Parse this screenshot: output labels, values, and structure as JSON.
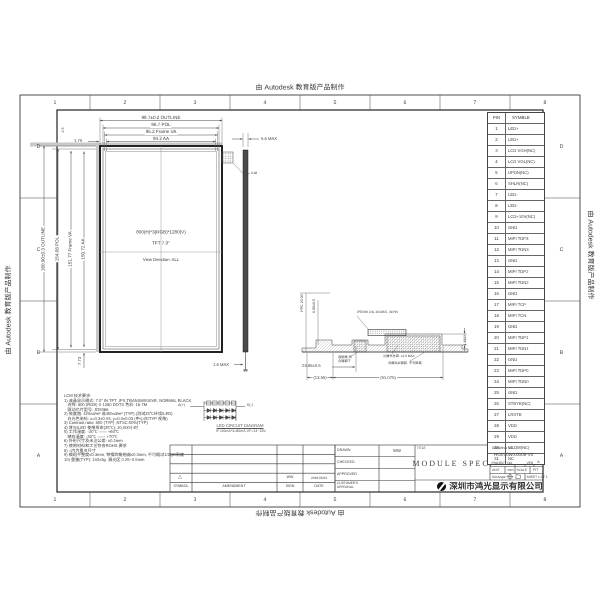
{
  "colors": {
    "line": "#3a3a3a",
    "panel_border": "#222222",
    "gray_strip": "#c8c8c8",
    "side_fill": "#4a4a4a"
  },
  "frame": {
    "autodesk_text": "由 Autodesk 教育版产品制作",
    "zone_columns": [
      "1",
      "2",
      "3",
      "4",
      "5",
      "6",
      "7",
      "8"
    ],
    "zone_rows": [
      "D",
      "C",
      "B",
      "A"
    ]
  },
  "pin_table": {
    "headers": [
      "PIN",
      "SYMBLE"
    ],
    "rows": [
      [
        "1",
        "LED+"
      ],
      [
        "2",
        "LED+"
      ],
      [
        "3",
        "LCD VGH(NC)"
      ],
      [
        "4",
        "LCD VGL(NC)"
      ],
      [
        "5",
        "UPDN(NC)"
      ],
      [
        "6",
        "SHLR(NC)"
      ],
      [
        "7",
        "LED-"
      ],
      [
        "8",
        "LED-"
      ],
      [
        "9",
        "LCD+10V(NC)"
      ],
      [
        "10",
        "GND"
      ],
      [
        "11",
        "MIPI TDP3"
      ],
      [
        "12",
        "MIPI TDN3"
      ],
      [
        "13",
        "GND"
      ],
      [
        "14",
        "MIPI TDP2"
      ],
      [
        "15",
        "MIPI TDN2"
      ],
      [
        "16",
        "GND"
      ],
      [
        "17",
        "MIPI TCP"
      ],
      [
        "18",
        "MIPI TCN"
      ],
      [
        "19",
        "GND"
      ],
      [
        "20",
        "MIPI TDP1"
      ],
      [
        "21",
        "MIPI TDN1"
      ],
      [
        "22",
        "GND"
      ],
      [
        "23",
        "MIPI TDP0"
      ],
      [
        "24",
        "MIPI TDN0"
      ],
      [
        "25",
        "GND"
      ],
      [
        "26",
        "STBYB(NC)"
      ],
      [
        "27",
        "LRSTB"
      ],
      [
        "28",
        "VDD"
      ],
      [
        "29",
        "VDD"
      ],
      [
        "30",
        "VCOM(NC)"
      ],
      [
        "31",
        "NC"
      ]
    ]
  },
  "front_view": {
    "dims_top": [
      "98.7±0.2 OUTLINE",
      "96.7 POL",
      "95.2 Frame VA",
      "94.2 AA"
    ],
    "dims_left": [
      "160.90±0.3 OUTLINE",
      "154.08 POL",
      "151.77 Frame VA",
      "150.72 AA"
    ],
    "dim_left_offset": "1.75",
    "dim_top_offset": "2.5",
    "dim_bottom_offset": "7.73",
    "corner_label": "0.98",
    "center_line1": "800(H)*3(RGB)*1280(V)",
    "center_line2": "TFT 7.0\"",
    "center_line3": "View Direction: ALL"
  },
  "side_view": {
    "dim_top": "5.6 MAX",
    "dim_bottom": "1.6 MAX"
  },
  "fpc_view": {
    "dim_fpc": "FPC 20.00",
    "dim_height": "6.85±0.5",
    "dim_offset": "23.65±0.5",
    "dim_left": "(13.55)",
    "dim_right": "(51.075)",
    "dim_thickness": "1 MAX",
    "connector_label": "IPEX08 2.0L 20198.5, 31PIN",
    "label_connector_side": "连接器 扣合面朝下",
    "label_component": "元器件总高: ≤1.5 MAX",
    "label_tape": "背面贴双面胶, 不可撕离"
  },
  "led_circuit": {
    "anode": "A(+)",
    "cathode": "K(-)",
    "title": "LED CIRCUIT DIAGRAM",
    "formula": "IF=20mA*4=80mA,VF=14~18V"
  },
  "notes": {
    "lines": [
      "LCM 技术要求:",
      "1) 液晶显示模式: 7.0\" IN TFT ,IPS,TRANSMISSIVE, NORMAL BLACK",
      "   点阵: 800 (RGB) X 1280 DOTS 色彩: 16.7M",
      "   驱动芯片型号: JD9366",
      "2) 亮度值: 420cd/m² 或450cd/m² (TYP) (测试25℃环境/LED)",
      "   白光色坐标: x=0.3±0.03, y=0.3±0.03 (中心点/TYP 视角)",
      "3) Contrast ratio: 800 (TYP) ,NTSC:50%(TYP)",
      "4) 背光/LED 使用寿命(25℃): 20,000小时",
      "5) 工作温度: -20℃ —— +60℃",
      "   储存温度: -30℃ —— +70℃",
      "6) 外形尺寸及未注公差: ±0.2mm",
      "7) 使用材料和工艺符合ROHS 要求",
      "8) ○内为重点尺寸",
      "9) 模组平整度≤0.3mm, 铁框四角翘曲≤0.3mm, 不可超过1/2QB限度",
      "10) 重量(TYP): 143±3g  漏光区 0.25~0.5mm"
    ]
  },
  "revision_table": {
    "headers": [
      "SYMBOL",
      "AMENDMENT",
      "SIGN",
      "DATE"
    ],
    "row": {
      "symbol": "△",
      "amendment": "",
      "sign": "WW",
      "date": "2018.03.03"
    }
  },
  "title_block": {
    "drawn_label": "DRAWN",
    "drawn_value": "WW",
    "checked_label": "CHECKED",
    "approved_label": "APPROVED",
    "customer_label": "CUSTOMER'S APPROVAL",
    "title_label": "TITLE",
    "title_value": "MODULE SPEC.",
    "drawing_no_label": "DRAWING NO.",
    "drawing_no": "HG070WX0008-V0",
    "project_label": "PROJECT NO.",
    "ver_label": "VER",
    "ver_value": "A",
    "unit_label": "UNIT",
    "unit_value": "mm",
    "scale_label": "SCALE",
    "scale_value": "FIT",
    "angle_label": "3rd Angle",
    "sheet_label": "SHEET 1 OF 1",
    "company": "深圳市鸿光显示有限公司"
  }
}
